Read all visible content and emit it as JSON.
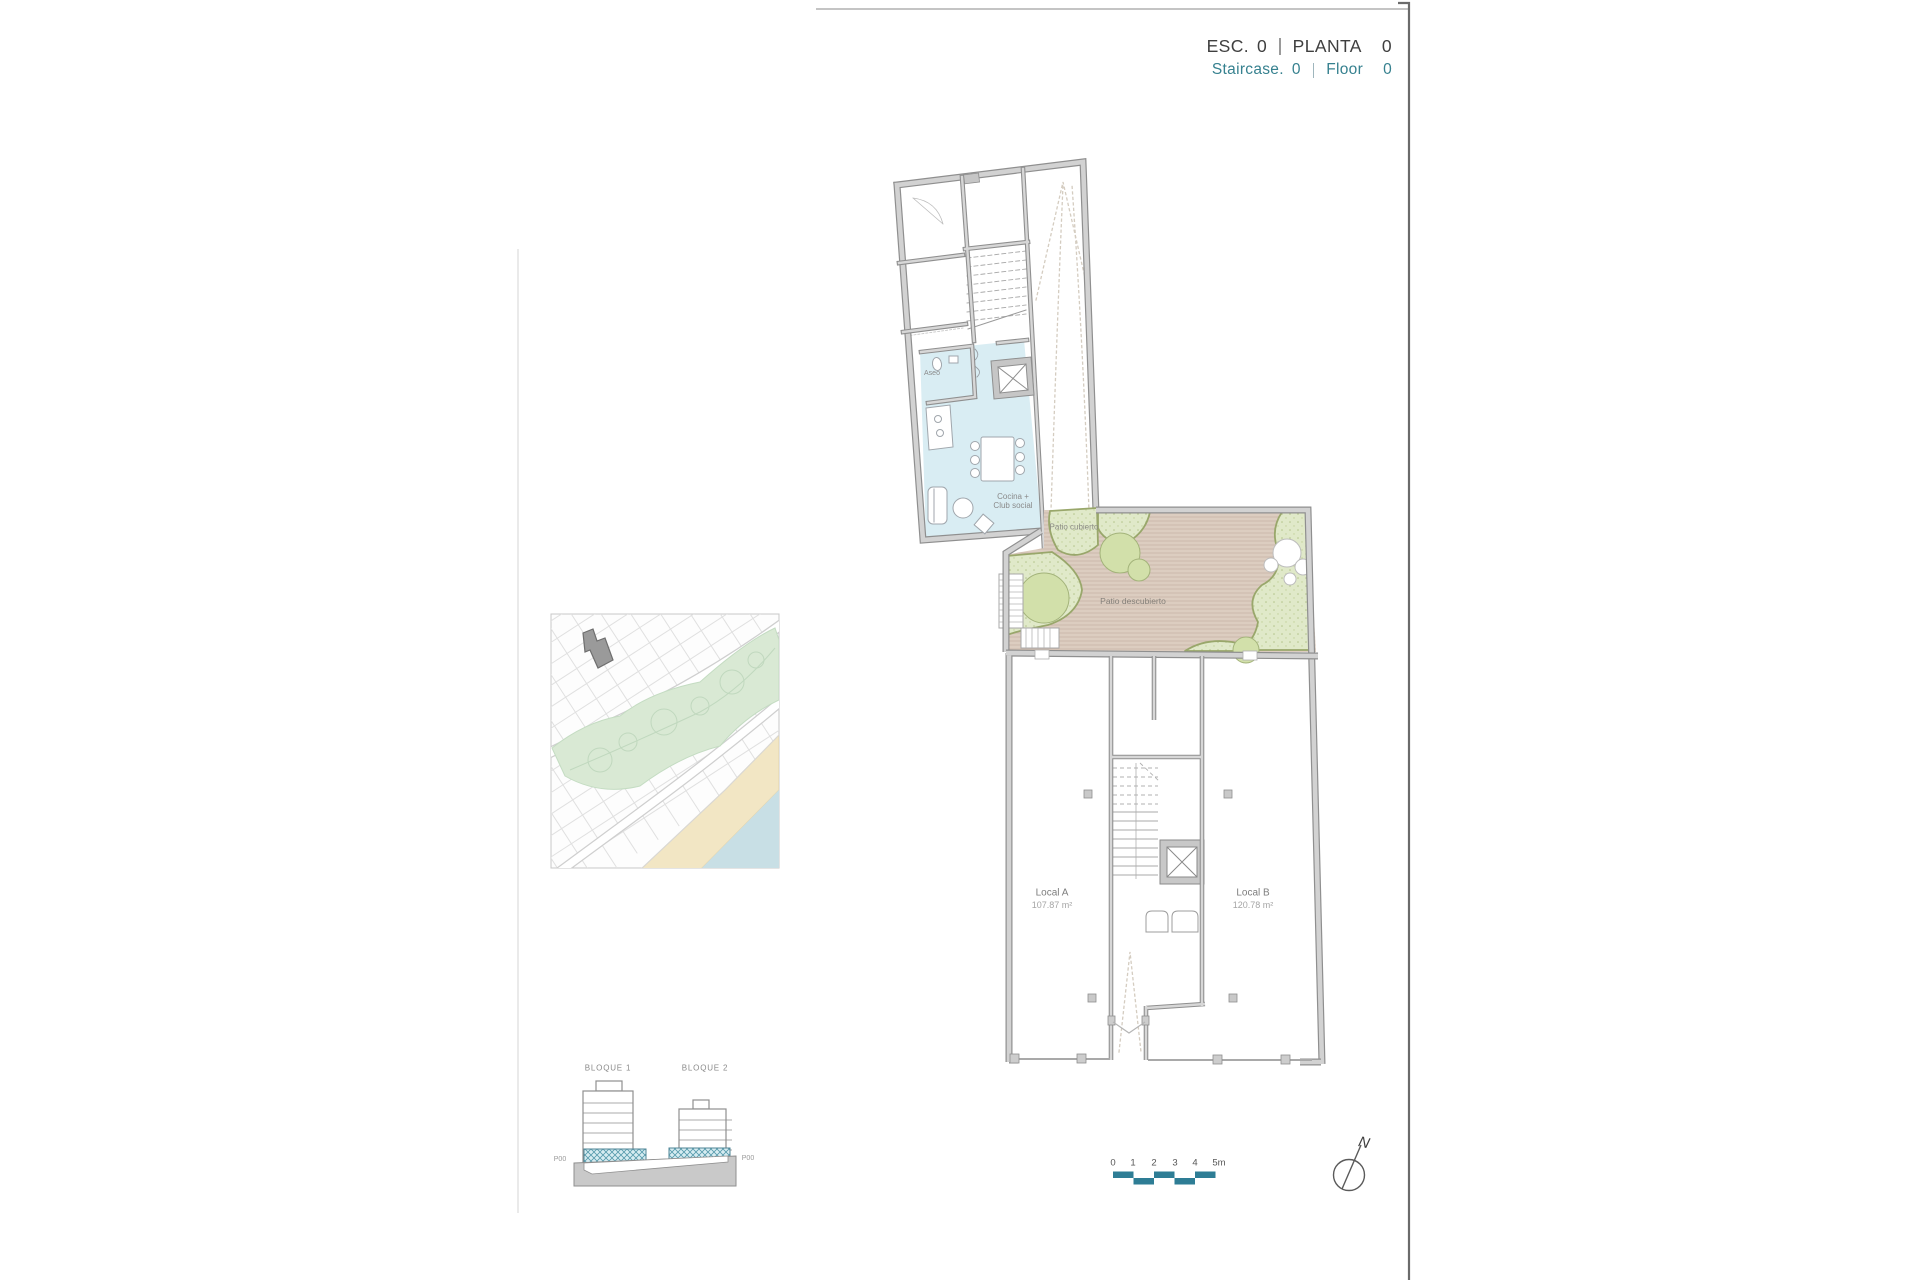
{
  "header": {
    "esc_label": "ESC.",
    "esc_value": "0",
    "planta_label": "PLANTA",
    "planta_value": "0",
    "staircase_label": "Staircase.",
    "staircase_value": "0",
    "floor_label": "Floor",
    "floor_value": "0"
  },
  "plan": {
    "labels": {
      "aseo": "Aseo",
      "cocina_line1": "Cocina +",
      "cocina_line2": "Club social",
      "patio_cubierto": "Patio cubierto",
      "patio_descubierto": "Patio descubierto",
      "local_a_name": "Local A",
      "local_a_area": "107.87 m²",
      "local_b_name": "Local B",
      "local_b_area": "120.78 m²"
    }
  },
  "elevation": {
    "block1_label": "BLOQUE 1",
    "block2_label": "BLOQUE 2",
    "level_left": "P00",
    "level_right": "P00"
  },
  "scale_bar": {
    "ticks": [
      "0",
      "1",
      "2",
      "3",
      "4",
      "5m"
    ]
  },
  "compass": {
    "north_label": "N"
  },
  "colors": {
    "accent_teal": "#36818f",
    "scale_bar_teal": "#2e7d95",
    "header_dark": "#3f3f3f",
    "wall_gray": "#c6c6c6",
    "club_room_blue": "#d9edf3",
    "patio_floor_tan": "#dccdc0",
    "planting_green": "#e0e9c9",
    "park_green": "#d9e9d4",
    "beach_sand": "#f2e6c4",
    "sea_blue": "#c8dfe5"
  }
}
